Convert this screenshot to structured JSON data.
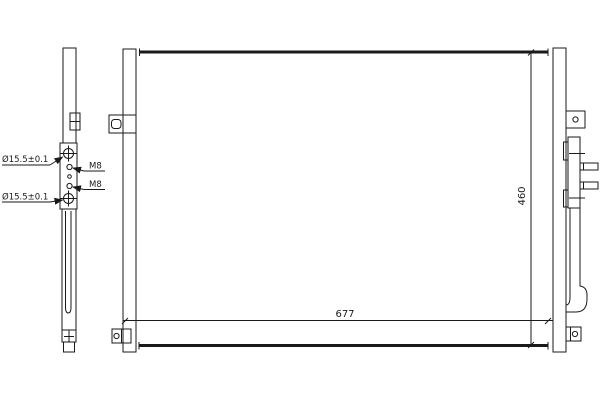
{
  "drawing": {
    "labels": {
      "diameter_top": "Ø15.5±0.1",
      "diameter_bottom": "Ø15.5±0.1",
      "thread_top": "M8",
      "thread_bottom": "M8"
    },
    "dimensions": {
      "width": "677",
      "height": "460"
    },
    "colors": {
      "line": "#1a1a1a",
      "background": "#ffffff"
    }
  }
}
